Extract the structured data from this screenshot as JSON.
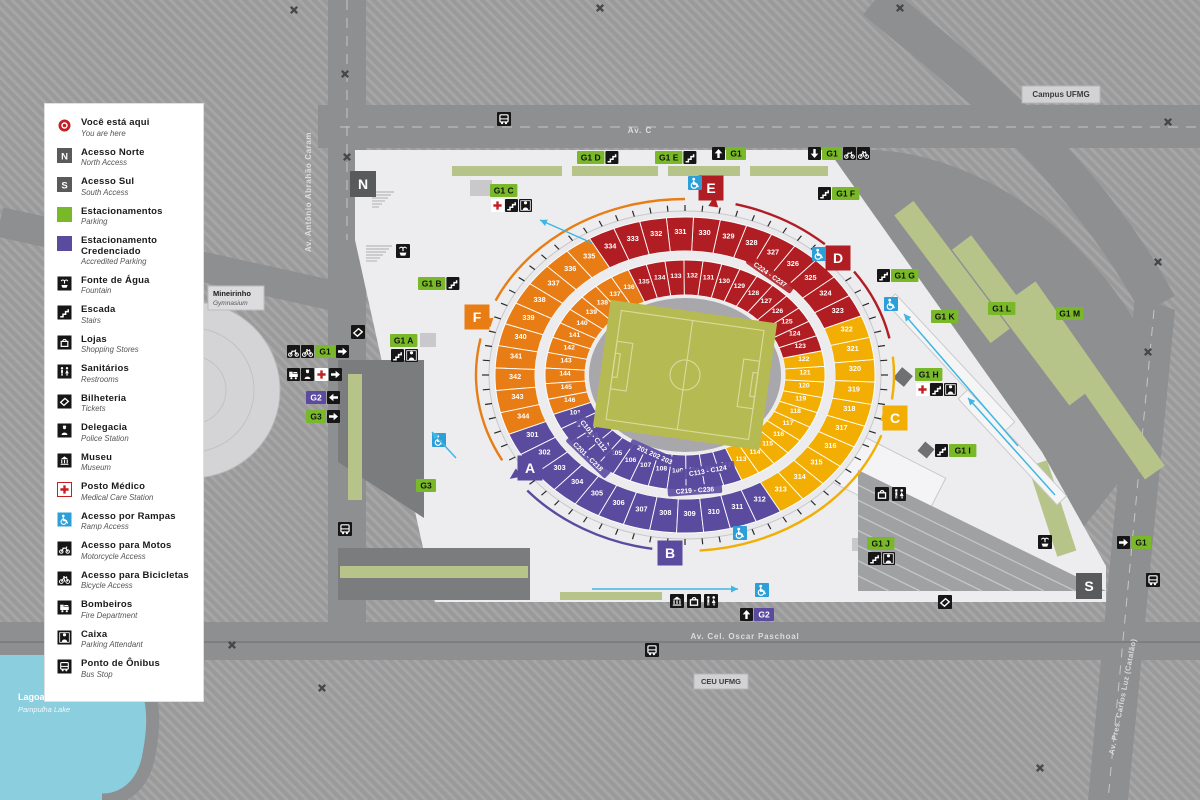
{
  "colors": {
    "purple": "#5b4b9f",
    "yellow": "#f2ae03",
    "red": "#b01e24",
    "orange": "#e87d15",
    "green": "#79b829",
    "olive": "#b7c489",
    "water": "#8bcede",
    "road": "#8e8f91",
    "block": "#9a9a9b",
    "plaza": "#ededef",
    "dark": "#595a5c",
    "black": "#161616",
    "blue": "#2d9fd8",
    "field": "#b6ba52"
  },
  "legend": {
    "items": [
      {
        "icon": "you-are-here",
        "label": "Você está aqui",
        "sub": "You are here"
      },
      {
        "icon": "letter-n",
        "label": "Acesso Norte",
        "sub": "North Access"
      },
      {
        "icon": "letter-s",
        "label": "Acesso Sul",
        "sub": "South Access"
      },
      {
        "icon": "parking-green",
        "label": "Estacionamentos",
        "sub": "Parking"
      },
      {
        "icon": "parking-purple",
        "label": "Estacionamento Credenciado",
        "sub": "Accredited Parking"
      },
      {
        "icon": "fountain",
        "label": "Fonte de Água",
        "sub": "Fountain"
      },
      {
        "icon": "stairs",
        "label": "Escada",
        "sub": "Stairs"
      },
      {
        "icon": "shops",
        "label": "Lojas",
        "sub": "Shopping Stores"
      },
      {
        "icon": "restrooms",
        "label": "Sanitários",
        "sub": "Restrooms"
      },
      {
        "icon": "ticket",
        "label": "Bilheteria",
        "sub": "Tickets"
      },
      {
        "icon": "police",
        "label": "Delegacia",
        "sub": "Police Station"
      },
      {
        "icon": "museum",
        "label": "Museu",
        "sub": "Museum"
      },
      {
        "icon": "medical",
        "label": "Posto Médico",
        "sub": "Medical Care Station"
      },
      {
        "icon": "wheelchair",
        "label": "Acesso por Rampas",
        "sub": "Ramp Access"
      },
      {
        "icon": "moto",
        "label": "Acesso para Motos",
        "sub": "Motorcycle Access"
      },
      {
        "icon": "bike",
        "label": "Acesso para Bicicletas",
        "sub": "Bicycle Access"
      },
      {
        "icon": "fire",
        "label": "Bombeiros",
        "sub": "Fire Department"
      },
      {
        "icon": "caixa",
        "label": "Caixa",
        "sub": "Parking Attendant"
      },
      {
        "icon": "bus",
        "label": "Ponto de Ônibus",
        "sub": "Bus Stop"
      }
    ]
  },
  "streets": {
    "av_c": "Av. C",
    "palmeiras": "Av. Palmeiras",
    "caram": "Av. Antônio Abrahão Caram",
    "paschoal": "Av. Cel. Oscar Paschoal",
    "catalao": "Av. Pres. Carlos Luz (Catalão)"
  },
  "places": {
    "campus": "Campus UFMG",
    "ceu": "CEU UFMG",
    "mineirinho": {
      "title": "Mineirinho",
      "sub": "Gymnasium"
    },
    "lagoa": {
      "title": "Lagoa da Pampulha",
      "sub": "Pampulha Lake"
    }
  },
  "stadium": {
    "upper_ring": {
      "start": 301,
      "count": 44,
      "offset_deg": 158,
      "bands": [
        {
          "to": 312,
          "color": "purple"
        },
        {
          "to": 322,
          "color": "yellow"
        },
        {
          "to": 334,
          "color": "red"
        },
        {
          "to": 344,
          "color": "orange"
        }
      ]
    },
    "lower_ring": {
      "start": 101,
      "count": 46,
      "offset_deg": 160,
      "bands": [
        {
          "to": 112,
          "color": "purple"
        },
        {
          "to": 122,
          "color": "yellow"
        },
        {
          "to": 135,
          "color": "red"
        },
        {
          "to": 146,
          "color": "orange"
        }
      ]
    },
    "cabin_labels": [
      {
        "text": "C101 - C112",
        "angle": 141,
        "rx": 118,
        "ry": 97,
        "rot": 51,
        "bg": "purple"
      },
      {
        "text": "C201 - C218",
        "angle": 134,
        "rx": 140,
        "ry": 114,
        "rot": 44,
        "bg": "purple"
      },
      {
        "text": "C113 - C124",
        "angle": 79,
        "rx": 120,
        "ry": 98,
        "rot": -10,
        "bg": "purple"
      },
      {
        "text": "C219 - C236",
        "angle": 86,
        "rx": 142,
        "ry": 116,
        "rot": -4,
        "bg": "purple"
      },
      {
        "text": "C224 - C237",
        "angle": -55,
        "rx": 148,
        "ry": 122,
        "rot": 35,
        "bg": "red"
      },
      {
        "text": "201 202 203",
        "angle": 107,
        "rx": 104,
        "ry": 84,
        "rot": 24,
        "bg": "purple"
      }
    ],
    "gates": [
      {
        "letter": "E",
        "x": 711,
        "y": 188,
        "color": "red"
      },
      {
        "letter": "D",
        "x": 838,
        "y": 258,
        "color": "red"
      },
      {
        "letter": "C",
        "x": 895,
        "y": 418,
        "color": "yellow"
      },
      {
        "letter": "B",
        "x": 670,
        "y": 553,
        "color": "purple"
      },
      {
        "letter": "A",
        "x": 530,
        "y": 468,
        "color": "purple"
      },
      {
        "letter": "F",
        "x": 477,
        "y": 317,
        "color": "orange"
      },
      {
        "letter": "N",
        "x": 363,
        "y": 184,
        "color": "dark"
      },
      {
        "letter": "S",
        "x": 1089,
        "y": 586,
        "color": "dark"
      }
    ],
    "arcs": [
      {
        "color": "red",
        "from": -76,
        "to": -48
      },
      {
        "color": "red",
        "from": -36,
        "to": -12
      },
      {
        "color": "yellow",
        "from": -6,
        "to": 8
      },
      {
        "color": "yellow",
        "from": 20,
        "to": 86
      },
      {
        "color": "purple",
        "from": 99,
        "to": 139
      },
      {
        "color": "orange",
        "from": 151,
        "to": 192
      },
      {
        "color": "orange",
        "from": 205,
        "to": 270
      }
    ],
    "arc_triangles": [
      {
        "angle": -82,
        "color": "red"
      },
      {
        "angle": -42,
        "color": "red"
      },
      {
        "angle": 14,
        "color": "yellow"
      },
      {
        "angle": 95,
        "color": "purple"
      },
      {
        "angle": 145,
        "color": "purple"
      },
      {
        "angle": 198,
        "color": "orange"
      }
    ]
  },
  "gate_signs": [
    {
      "label": "G1 D",
      "post": [
        "stairs"
      ],
      "x": 577,
      "y": 151
    },
    {
      "label": "G1 E",
      "post": [
        "stairs"
      ],
      "x": 655,
      "y": 151
    },
    {
      "label": "G1",
      "pre": [
        "arrow-up"
      ],
      "x": 712,
      "y": 147
    },
    {
      "label": "G1",
      "pre": [
        "arrow-down"
      ],
      "post": [
        "moto",
        "bike"
      ],
      "x": 808,
      "y": 147
    },
    {
      "label": "G1 C",
      "below": [
        "medical",
        "stairs",
        "caixa"
      ],
      "x": 490,
      "y": 184
    },
    {
      "label": "G1 B",
      "post": [
        "stairs"
      ],
      "x": 418,
      "y": 277
    },
    {
      "label": "G1 A",
      "below": [
        "stairs",
        "caixa"
      ],
      "x": 390,
      "y": 334
    },
    {
      "label": "G1 F",
      "pre": [
        "stairs"
      ],
      "x": 818,
      "y": 187
    },
    {
      "label": "G1 G",
      "pre": [
        "stairs"
      ],
      "x": 877,
      "y": 269
    },
    {
      "label": "G1 K",
      "x": 931,
      "y": 310
    },
    {
      "label": "G1 L",
      "x": 988,
      "y": 302
    },
    {
      "label": "G1 M",
      "x": 1056,
      "y": 307
    },
    {
      "label": "G1 H",
      "below": [
        "medical",
        "stairs",
        "caixa"
      ],
      "x": 915,
      "y": 368
    },
    {
      "label": "G1 I",
      "pre": [
        "stairs"
      ],
      "x": 935,
      "y": 444
    },
    {
      "label": "G1 J",
      "below": [
        "stairs",
        "caixa"
      ],
      "x": 867,
      "y": 537
    },
    {
      "label": "G1",
      "pre": [
        "arrow-right"
      ],
      "x": 1117,
      "y": 536
    },
    {
      "label": "G2",
      "color": "purple",
      "pre": [
        "arrow-up"
      ],
      "x": 740,
      "y": 608
    },
    {
      "label": "G3",
      "x": 416,
      "y": 479
    },
    {
      "label": "G1",
      "pre": [
        "moto",
        "bike"
      ],
      "post": [
        "arrow-right"
      ],
      "x": 287,
      "y": 345
    },
    {
      "pre": [
        "fire",
        "police",
        "medical"
      ],
      "post": [
        "arrow-right"
      ],
      "x": 287,
      "y": 368
    },
    {
      "label": "G2",
      "color": "purple",
      "post": [
        "arrow-left"
      ],
      "x": 306,
      "y": 391
    },
    {
      "label": "G3",
      "post": [
        "arrow-right"
      ],
      "x": 306,
      "y": 410
    }
  ],
  "map_icons": [
    {
      "icon": "bus",
      "x": 497,
      "y": 112
    },
    {
      "icon": "bus",
      "x": 645,
      "y": 643
    },
    {
      "icon": "bus",
      "x": 1146,
      "y": 573
    },
    {
      "icon": "bus",
      "x": 338,
      "y": 522
    },
    {
      "icon": "fountain",
      "x": 396,
      "y": 244
    },
    {
      "icon": "fountain",
      "x": 1038,
      "y": 535
    },
    {
      "icon": "ticket",
      "x": 351,
      "y": 325
    },
    {
      "icon": "ticket",
      "x": 938,
      "y": 595
    },
    {
      "icon": "museum",
      "x": 670,
      "y": 594
    },
    {
      "icon": "shops",
      "x": 687,
      "y": 594
    },
    {
      "icon": "restrooms",
      "x": 704,
      "y": 594
    },
    {
      "icon": "shops",
      "x": 875,
      "y": 487
    },
    {
      "icon": "restrooms",
      "x": 892,
      "y": 487
    },
    {
      "icon": "wheelchair",
      "x": 688,
      "y": 176
    },
    {
      "icon": "wheelchair",
      "x": 812,
      "y": 247
    },
    {
      "icon": "wheelchair",
      "x": 884,
      "y": 297
    },
    {
      "icon": "wheelchair",
      "x": 733,
      "y": 526
    },
    {
      "icon": "wheelchair",
      "x": 755,
      "y": 583
    },
    {
      "icon": "wheelchair",
      "x": 432,
      "y": 433
    }
  ],
  "ramp_arrows": [
    [
      592,
      243,
      540,
      220
    ],
    [
      456,
      458,
      432,
      432
    ],
    [
      1018,
      446,
      904,
      314
    ],
    [
      1055,
      495,
      968,
      398
    ],
    [
      592,
      589,
      738,
      589
    ]
  ],
  "trees": [
    [
      600,
      8
    ],
    [
      900,
      8
    ],
    [
      294,
      10
    ],
    [
      345,
      74
    ],
    [
      347,
      157
    ],
    [
      232,
      645
    ],
    [
      322,
      688
    ],
    [
      1168,
      122
    ],
    [
      1158,
      262
    ],
    [
      1148,
      352
    ],
    [
      1040,
      768
    ]
  ]
}
